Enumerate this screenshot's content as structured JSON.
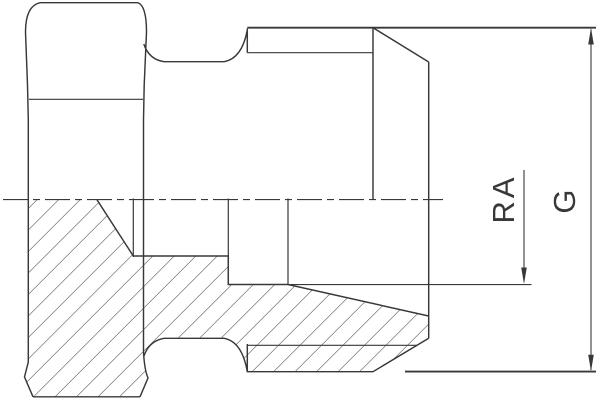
{
  "drawing": {
    "kind": "technical-cross-section-of-threaded-hex-fitting",
    "labels": {
      "ra": "RA",
      "g": "G"
    },
    "colors": {
      "line": "#383838",
      "background": "#ffffff"
    }
  }
}
